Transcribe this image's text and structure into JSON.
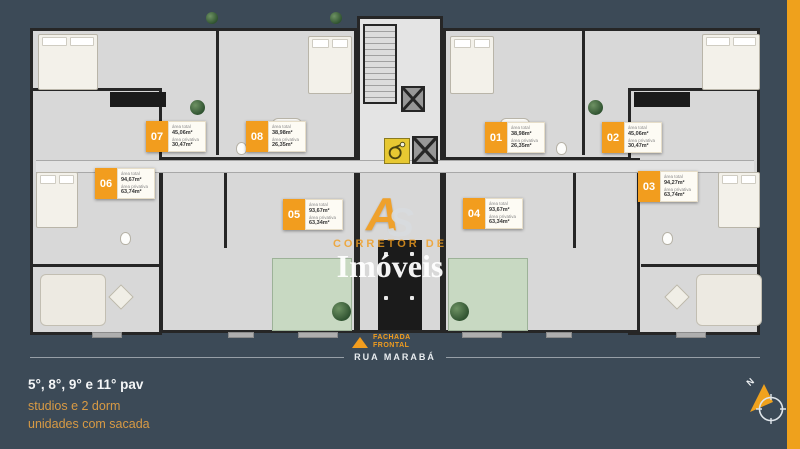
{
  "colors": {
    "background": "#3c4a57",
    "accent_orange": "#f29d1e",
    "stripe_orange": "#efa11c",
    "balcony_green": "#c8d9c2"
  },
  "plan": {
    "area_total_label": "área total",
    "area_privativa_label": "área privativa",
    "units": [
      {
        "number": "07",
        "area_total": "45,06m²",
        "area_privativa": "30,47m²"
      },
      {
        "number": "08",
        "area_total": "38,98m²",
        "area_privativa": "26,35m²"
      },
      {
        "number": "01",
        "area_total": "38,98m²",
        "area_privativa": "26,35m²"
      },
      {
        "number": "02",
        "area_total": "45,06m²",
        "area_privativa": "30,47m²"
      },
      {
        "number": "06",
        "area_total": "94,67m²",
        "area_privativa": "63,74m²"
      },
      {
        "number": "03",
        "area_total": "94,27m²",
        "area_privativa": "63,74m²"
      },
      {
        "number": "05",
        "area_total": "93,67m²",
        "area_privativa": "63,34m²"
      },
      {
        "number": "04",
        "area_total": "93,67m²",
        "area_privativa": "63,34m²"
      }
    ]
  },
  "watermark": {
    "logo_a": "A",
    "logo_s": "S",
    "line1": "CORRETOR DE",
    "line2": "Imóveis"
  },
  "facade": {
    "line1": "FACHADA",
    "line2": "FRONTAL"
  },
  "street": {
    "name": "RUA MARABÁ"
  },
  "footer": {
    "floors": "5°, 8°, 9° e 11° pav",
    "line2": "studios e 2 dorm",
    "line3": "unidades com sacada"
  },
  "compass": {
    "north": "N"
  }
}
